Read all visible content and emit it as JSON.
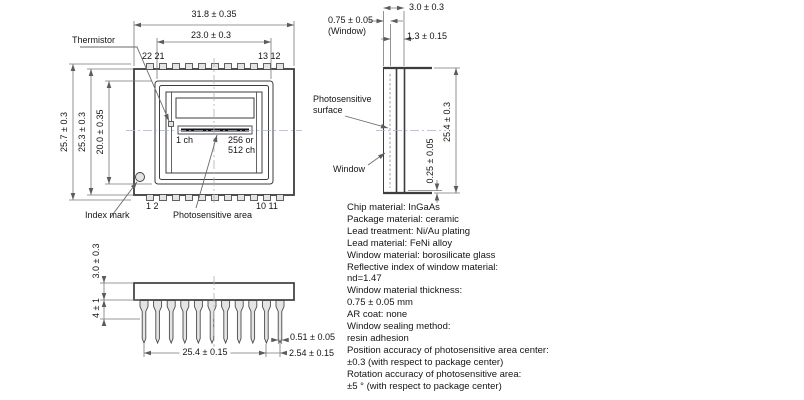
{
  "front_view": {
    "dim_width_outer": "31.8 ± 0.35",
    "dim_width_window": "23.0 ± 0.3",
    "dim_height_overall": "25.7 ± 0.3",
    "dim_height_body": "25.3 ± 0.3",
    "dim_height_frame": "20.0 ± 0.35",
    "thermistor": "Thermistor",
    "index_mark": "Index mark",
    "photosensitive_area": "Photosensitive area",
    "ch_first": "1 ch",
    "ch_last_line1": "256 or",
    "ch_last_line2": "512 ch",
    "pins_top_left": "22 21",
    "pins_top_right": "13 12",
    "pins_bottom_left": "1 2",
    "pins_bottom_right": "10 11"
  },
  "side_view": {
    "dim_thickness": "3.0 ± 0.3",
    "dim_window": "0.75 ± 0.05",
    "dim_window_note": "(Window)",
    "dim_lip": "1.3 ± 0.15",
    "dim_height": "25.4 ± 0.3",
    "dim_bottom": "0.25 ± 0.05",
    "photosensitive_surface_line1": "Photosensitive",
    "photosensitive_surface_line2": "surface",
    "window": "Window"
  },
  "bottom_view": {
    "dim_body": "3.0 ± 0.3",
    "dim_shoulder": "4 ± 1",
    "dim_span": "25.4 ± 0.15",
    "dim_pitch": "2.54 ± 0.15",
    "dim_lead_width": "0.51 ± 0.05"
  },
  "specs": {
    "lines": [
      "Chip material: InGaAs",
      "Package material: ceramic",
      "Lead treatment: Ni/Au plating",
      "Lead material: FeNi alloy",
      "Window material: borosilicate glass",
      "Reflective index of window material:",
      "nd=1.47",
      "Window material thickness:",
      "0.75 ± 0.05 mm",
      "AR coat: none",
      "Window sealing method:",
      "resin adhesion",
      "Position accuracy of photosensitive area center:",
      "±0.3 (with respect to package center)",
      "Rotation accuracy of photosensitive area:",
      "±5 ° (with respect to package center)"
    ]
  },
  "colors": {
    "line": "#3d3d3d",
    "dim": "#787878",
    "arrow": "#5c5c5c",
    "leader": "#6a6a6a",
    "centerline": "#a9b3bf",
    "fill_light": "#e4e4e4",
    "bar": "#151515",
    "text": "#141414"
  }
}
